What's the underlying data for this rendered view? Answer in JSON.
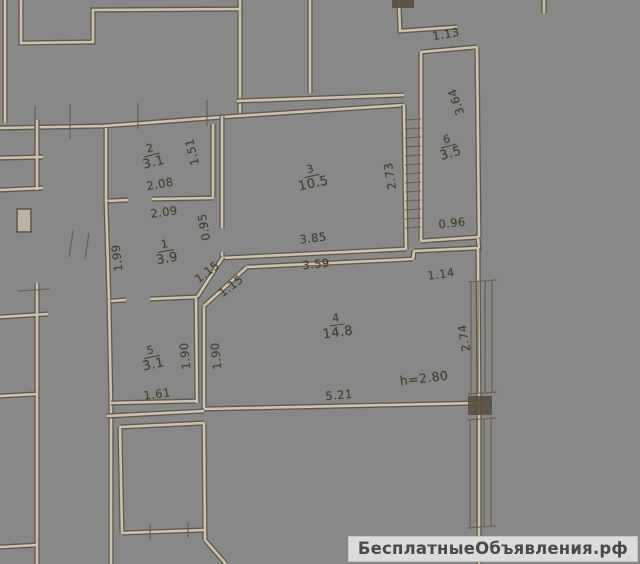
{
  "plan": {
    "rooms": {
      "r1": {
        "number": "1",
        "area": "3.9"
      },
      "r2": {
        "number": "2",
        "area": "3.1"
      },
      "r3": {
        "number": "3",
        "area": "10.5"
      },
      "r4": {
        "number": "4",
        "area": "14.8"
      },
      "r5": {
        "number": "5",
        "area": "3.1"
      },
      "r6": {
        "number": "6",
        "area": "3.5"
      }
    },
    "dims": {
      "d208": "2.08",
      "d151": "1.51",
      "d209": "2.09",
      "d095": "0.95",
      "d199": "1.99",
      "d115a": "1.15",
      "d115b": "1.15",
      "d385": "3.85",
      "d273": "2.73",
      "d113": "1.13",
      "d364": "3.64",
      "d096": "0.96",
      "d359": "3.59",
      "d114": "1.14",
      "d274": "2.74",
      "d521": "5.21",
      "d190a": "1.90",
      "d190b": "1.90",
      "d161": "1.61",
      "height_note": "h=2.80"
    }
  },
  "watermark": {
    "text": "БесплатныеОбъявления.рф"
  }
}
